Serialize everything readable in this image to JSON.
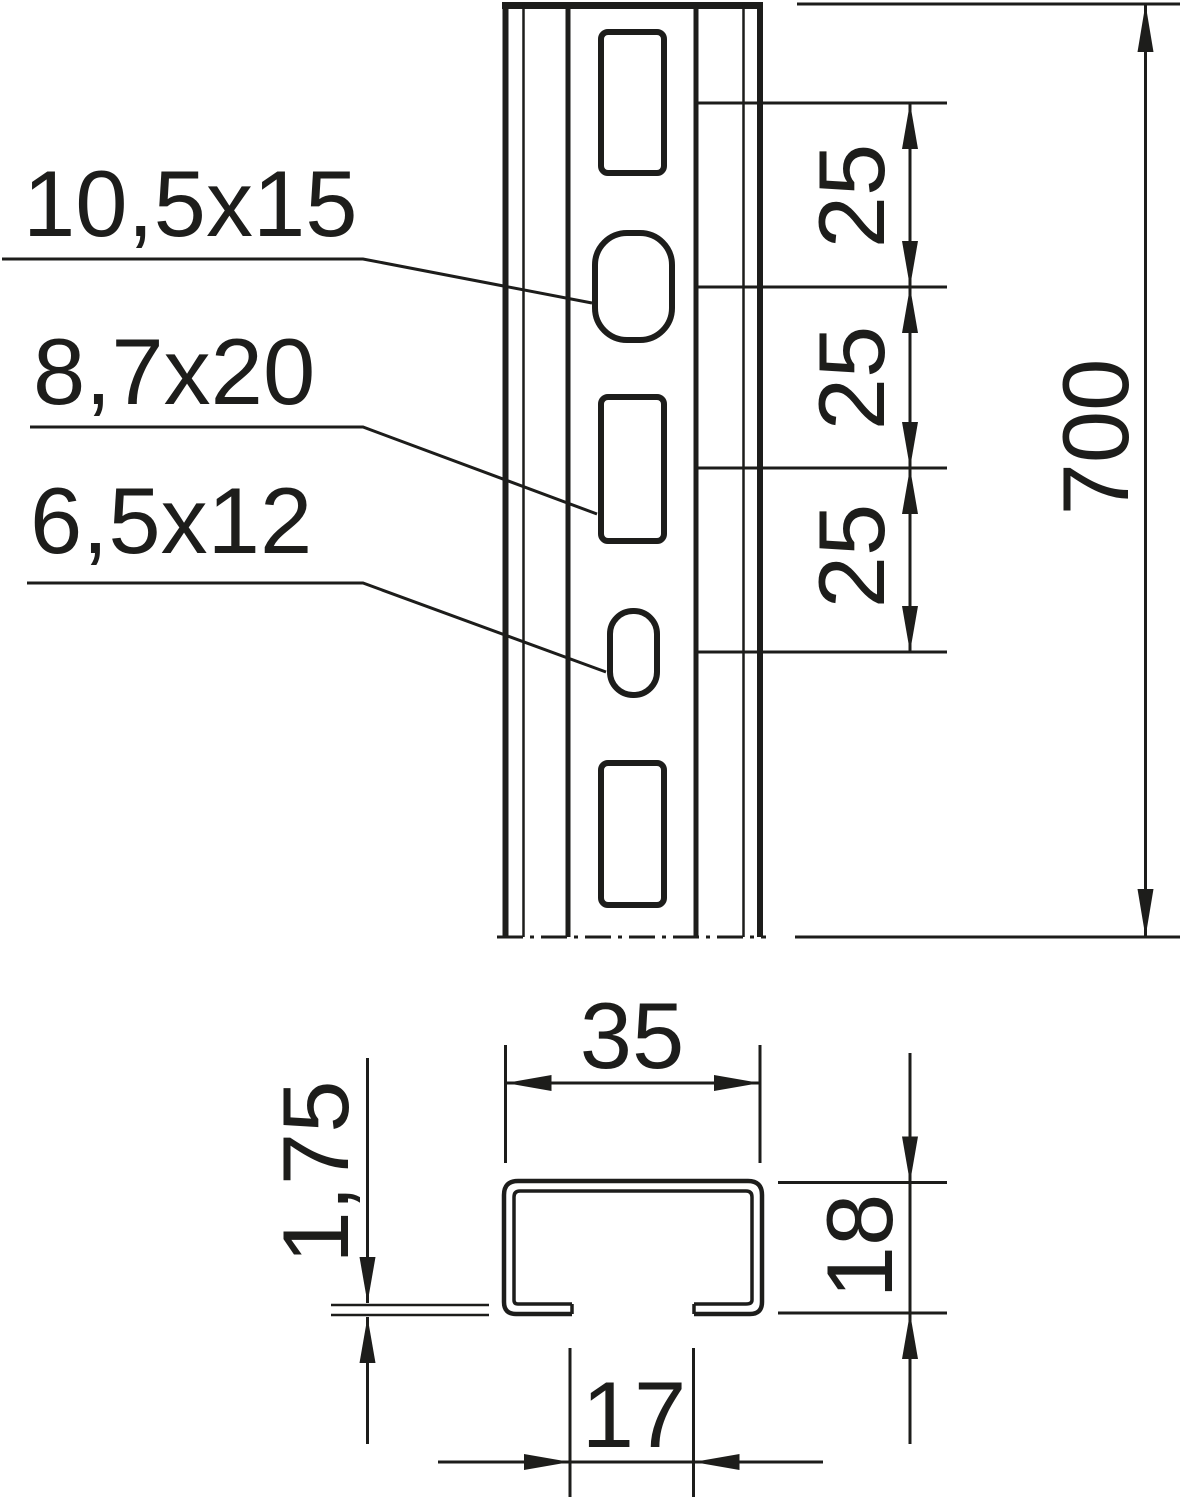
{
  "labels": {
    "oval_large": "10,5x15",
    "rect_slot": "8,7x20",
    "oval_small": "6,5x12"
  },
  "dims": {
    "pitches": [
      "25",
      "25",
      "25"
    ],
    "total_length": "700",
    "profile_width": "35",
    "material_thickness": "1,75",
    "profile_height": "18",
    "slot_opening": "17"
  },
  "colors": {
    "line": "#1d1d1b",
    "background": "#ffffff"
  }
}
